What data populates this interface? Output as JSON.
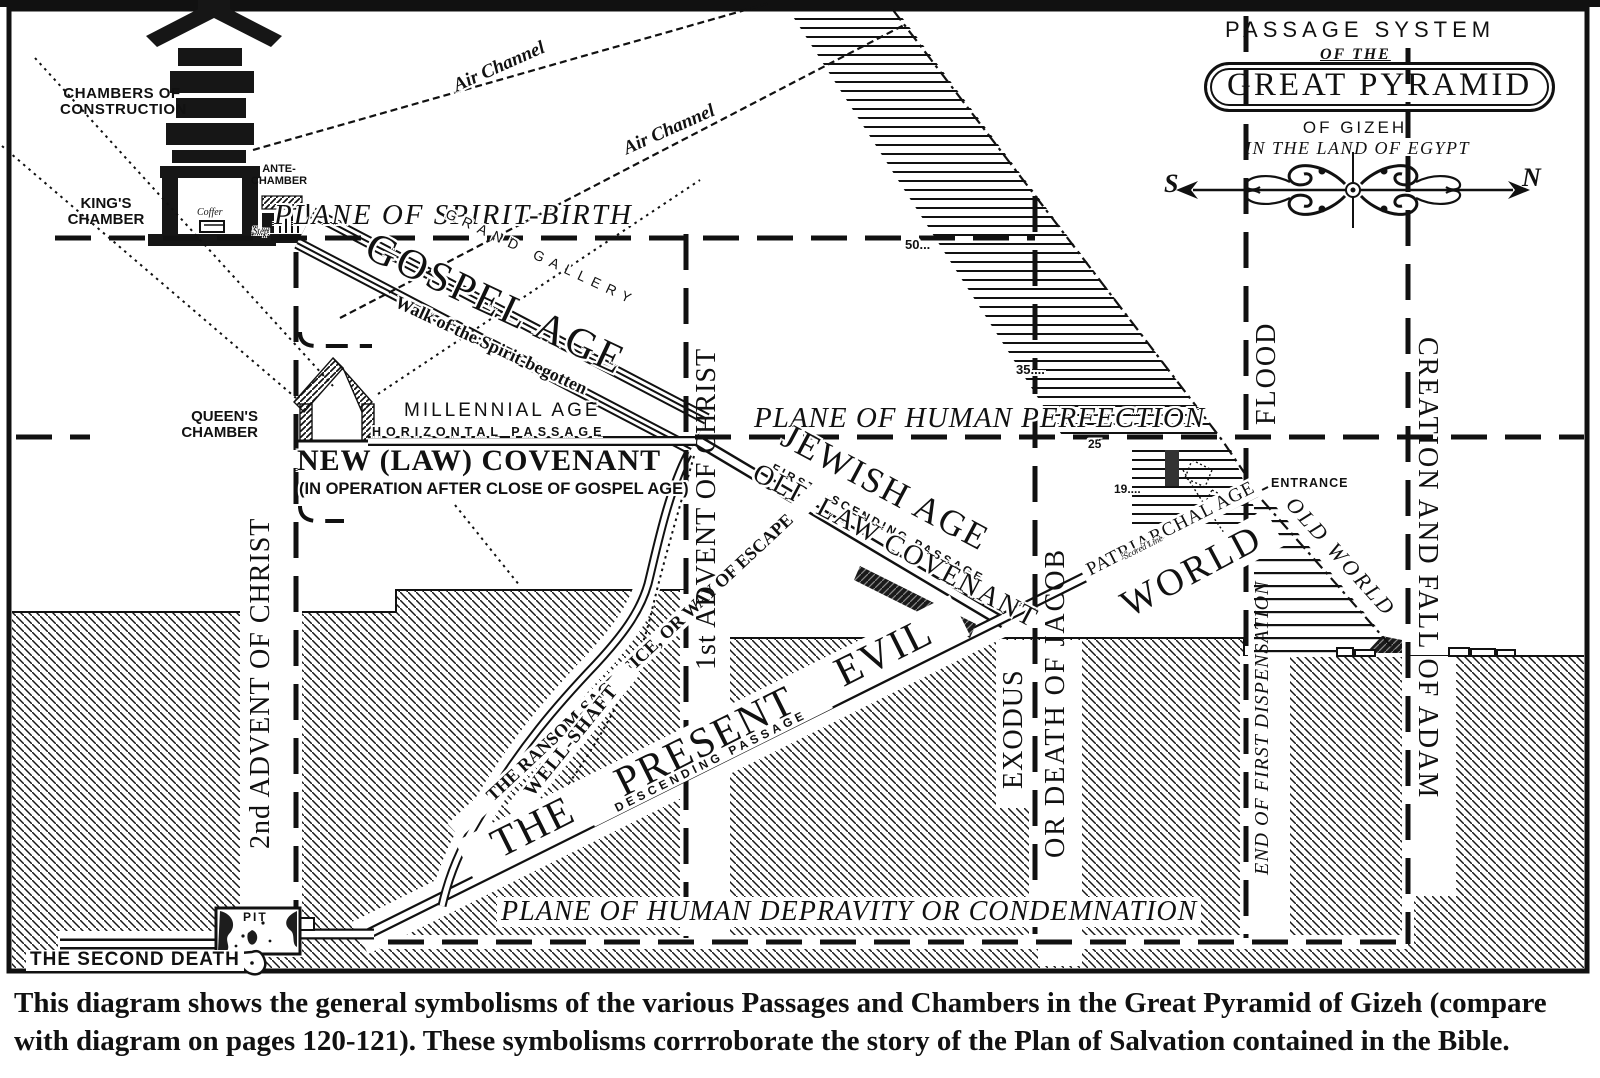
{
  "colors": {
    "ink": "#111111",
    "paper": "#ffffff"
  },
  "title_block": {
    "line1": "PASSAGE SYSTEM",
    "line2": "OF THE",
    "line3": "GREAT PYRAMID",
    "line4": "OF GIZEH",
    "line5": "IN THE LAND OF EGYPT",
    "compass_south": "S",
    "compass_north": "N"
  },
  "chambers": {
    "construction": "CHAMBERS OF\nCONSTRUCTION",
    "kings": "KING'S\nCHAMBER",
    "ante": "ANTE-\nCHAMBER",
    "queens": "QUEEN'S\nCHAMBER",
    "coffer": "Coffer",
    "step": "Step",
    "pit": "PIT",
    "entrance": "ENTRANCE"
  },
  "passages": {
    "grand_gallery": "GRAND GALLERY",
    "horizontal": "HORIZONTAL PASSAGE",
    "first_ascending": "FIRST ASCENDING PASSAGE",
    "descending": "DESCENDING PASSAGE",
    "well_shaft": "WELL-SHAFT",
    "air_channel_a": "Air Channel",
    "air_channel_b": "Air Channel",
    "scored_line": "Scored Line"
  },
  "planes": {
    "spirit_birth": "PLANE OF SPIRIT-BIRTH",
    "human_perfection": "PLANE OF HUMAN PERFECTION",
    "human_depravity": "PLANE OF HUMAN DEPRAVITY OR CONDEMNATION"
  },
  "ages": {
    "gospel": "GOSPEL AGE",
    "walk_of_spirit": "Walk of the Spirit-begotten",
    "millennial": "MILLENNIAL AGE",
    "new_covenant": "NEW (LAW) COVENANT",
    "new_covenant_note": "(IN OPERATION AFTER CLOSE OF GOSPEL AGE)",
    "jewish": "JEWISH AGE",
    "old_law_covenant": "OLD LAW COVENANT",
    "patriarchal": "PATRIARCHAL AGE",
    "present_evil": "THE PRESENT EVIL",
    "world": "WORLD",
    "old_world": "OLD WORLD",
    "ransom": "THE RANSOM-SACRIFICE, OR WAY OF ESCAPE",
    "second_death": "THE SECOND DEATH"
  },
  "timeline": {
    "advent1": "1st ADVENT OF CHRIST",
    "advent2": "2nd ADVENT OF CHRIST",
    "exodus": "EXODUS",
    "death_of_jacob": "OR DEATH OF JACOB",
    "flood": "FLOOD",
    "end_first_dispensation": "END OF FIRST DISPENSATION",
    "creation_fall": "CREATION AND FALL OF ADAM"
  },
  "course_numbers": {
    "n50": "50...",
    "n35": "35....",
    "n25": "25",
    "n19": "19...."
  },
  "caption": {
    "line1": "This diagram shows the general symbolisms of the various Passages and Chambers in the Great Pyramid of Gizeh (compare",
    "line2": "with diagram on pages 120-121).  These symbolisms corrroborate the story of the Plan of Salvation contained in the Bible."
  }
}
